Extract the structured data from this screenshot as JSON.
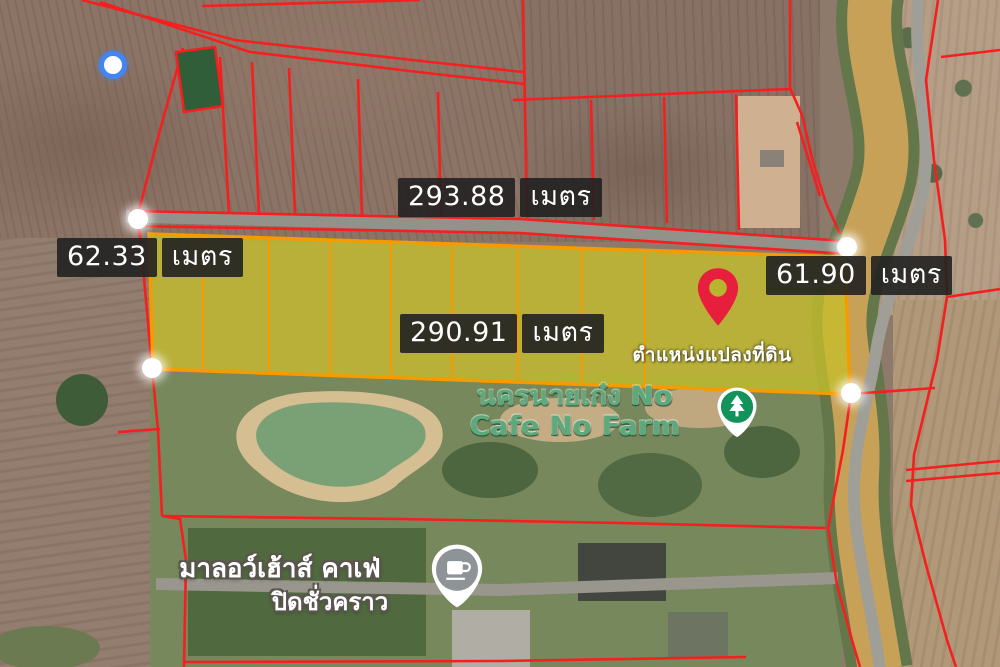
{
  "app": {
    "type": "satellite-map-parcel-annotation"
  },
  "measurements": {
    "top": {
      "value": "293.88",
      "unit": "เมตร"
    },
    "left": {
      "value": "62.33",
      "unit": "เมตร"
    },
    "right": {
      "value": "61.90",
      "unit": "เมตร"
    },
    "center": {
      "value": "290.91",
      "unit": "เมตร"
    }
  },
  "parcel": {
    "pin_caption": "ตำแหน่งแปลงที่ดิน"
  },
  "pois": {
    "farm": {
      "line1": "นครนายเก๋ง No",
      "line2": "Cafe No Farm",
      "icon": "tree-marker-icon"
    },
    "cafe": {
      "line1": "มาลอว์เฮ้าส์ คาเฟ่",
      "line2": "ปิดชั่วคราว",
      "icon": "coffee-cup-marker-icon"
    }
  },
  "markers": {
    "location_pin": "red-map-pin",
    "current_location": "blue-dot",
    "parcel_vertex_count": 4
  },
  "colors": {
    "parcel_fill": "#c5bf2b",
    "parcel_border": "#f59b00",
    "cadastral_line": "#f51f1f",
    "pin_red": "#e71f3d",
    "poi_green": "#12935b",
    "location_blue": "#4285f4",
    "label_bg": "#212121",
    "label_text": "#ffffff"
  }
}
